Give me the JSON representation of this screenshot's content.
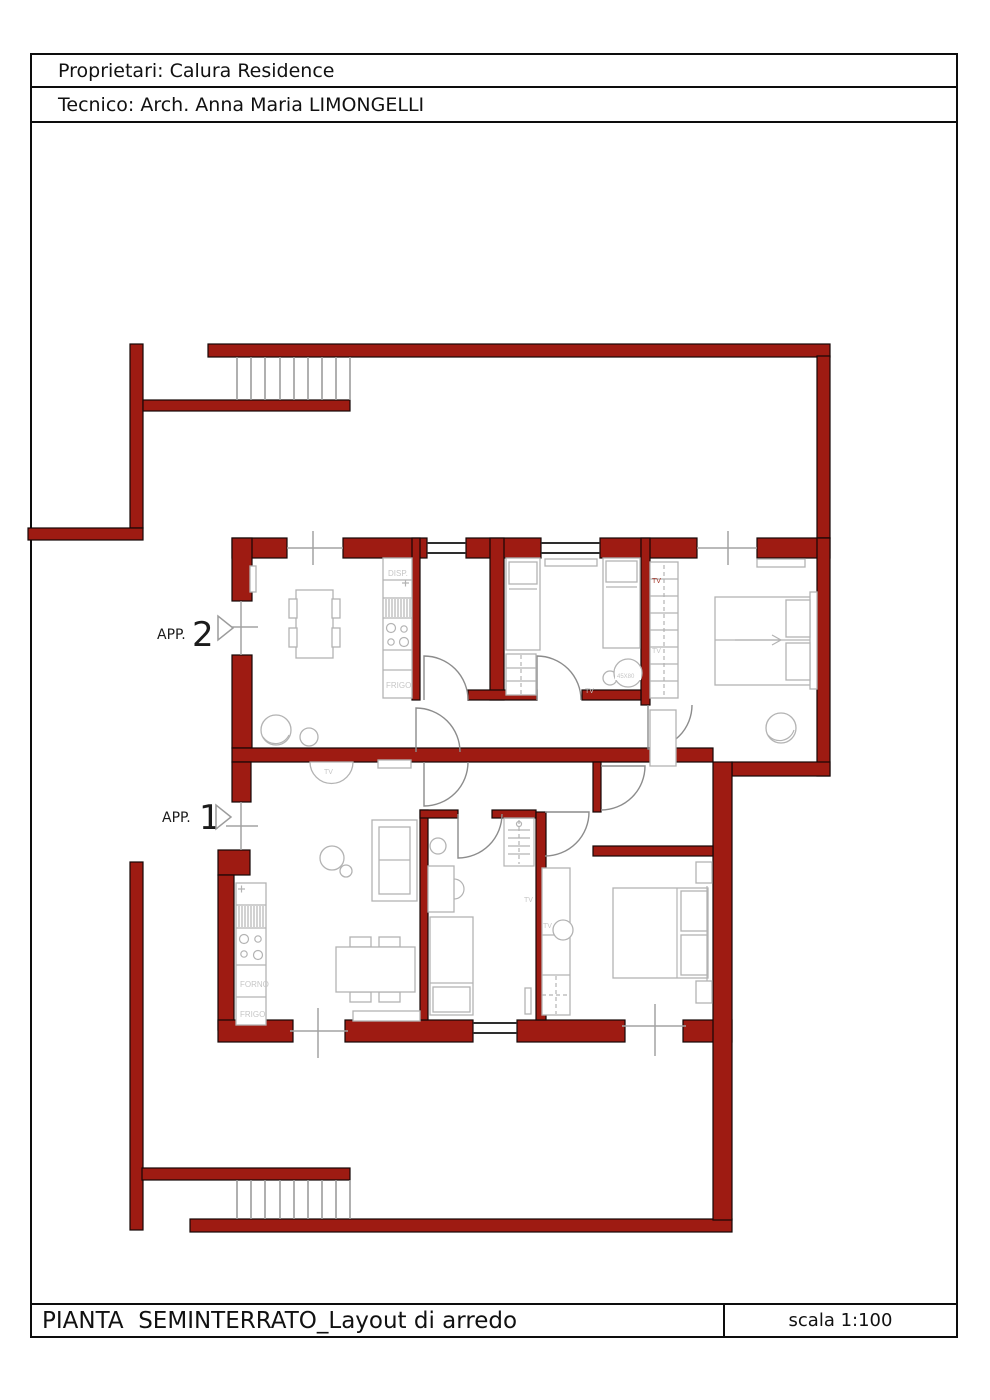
{
  "page": {
    "header": {
      "proprietari": "Proprietari: Calura Residence",
      "tecnico": "Tecnico: Arch. Anna Maria LIMONGELLI"
    },
    "footer": {
      "title": "PIANTA  SEMINTERRATO_Layout di arredo",
      "scale": "scala 1:100"
    }
  },
  "plan": {
    "apartments": [
      {
        "id": "app1",
        "label_prefix": "APP.",
        "label_number": "1"
      },
      {
        "id": "app2",
        "label_prefix": "APP.",
        "label_number": "2"
      }
    ],
    "furniture_labels": {
      "disp": "DISP.",
      "frigo": "FRIGO",
      "forno": "FORNO",
      "tv": "TV",
      "small_table": "45X80"
    },
    "colors": {
      "wall_red": "#9e1b12",
      "furniture_gray": "#b3b3b3",
      "door_gray": "#8c8c8c",
      "axis_gray": "#a3a3a3",
      "label_gray": "#c6c6c6",
      "tv_red": "#a43528"
    }
  }
}
